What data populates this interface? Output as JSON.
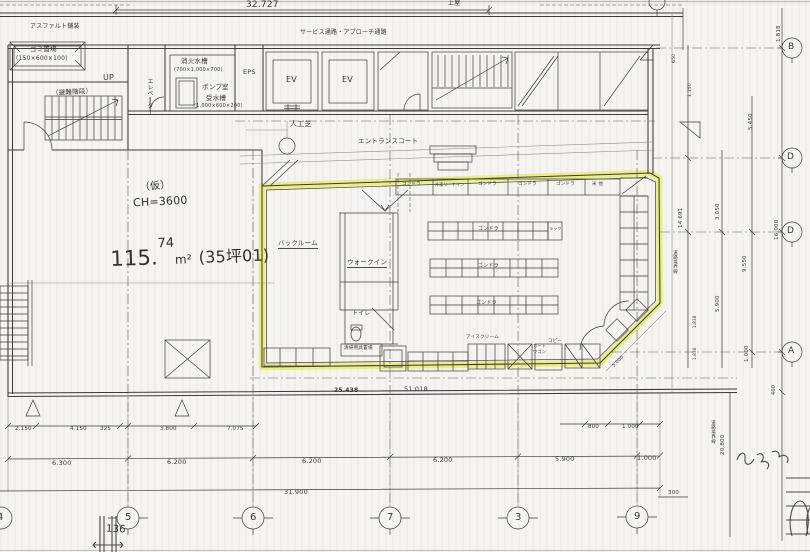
{
  "colors": {
    "highlight": "#e3ea52",
    "ink": "#3c3c3c",
    "paper": "#f5f4f0"
  },
  "top": {
    "dim_total": "32.727",
    "canopy": "上屋",
    "service_note": "サービス通路・アプローチ通路",
    "asphalt_note": "アスファルト舗装",
    "bin_room": "ゴミ置場",
    "bin_size": "(150×600×100)"
  },
  "rooms": {
    "up": "UP",
    "stair_note": "（避難階段）",
    "elevator": "エレベーター",
    "fire_tank": "消火水槽",
    "fire_tank_size": "(700×1,000×700)",
    "pump_room": "ポンプ室",
    "water_tank": "受水槽",
    "water_tank_size": "(1,000×600×200)",
    "eps": "EPS",
    "ev1": "EV",
    "ev2": "EV",
    "turf": "人工芝",
    "entrance_court": "エントランスコート"
  },
  "store": {
    "tenant_note": "（仮）",
    "ceiling_note": "CH=3600",
    "area_int": "115.",
    "area_dec": "74",
    "area_unit": "m²",
    "area_tsubo": "(35坪01)",
    "backroom": "バックルーム",
    "walkin": "ウォークイン",
    "toilet": "トイレ",
    "cleaning": "清掃用具置場",
    "ice": "アイスクリーム",
    "cart1": "カート",
    "cart2": "ワゴン",
    "copy": "コピー",
    "diag_dim": "5.000",
    "wall_fixtures": [
      "ゴンドラ",
      "冷凍リーチイン",
      "ゴンドラ",
      "ゴンドラ",
      "ゴンドラ",
      "米 他"
    ],
    "gondola1": "ゴンドラ",
    "gondola2": "ゴンドラ",
    "gondola3": "ゴンドラ",
    "rack": "ラック"
  },
  "levels": {
    "bm1": "25.438",
    "bm2": "51.018"
  },
  "dims": {
    "bottom_row1": [
      "2.150",
      "4.150",
      "325",
      "3.800",
      "7.075"
    ],
    "bottom_row1r": [
      "800",
      "1.000"
    ],
    "bottom_row2": [
      "6.300",
      "6.200",
      "6.200",
      "6.200",
      "5.900",
      "1.000"
    ],
    "bottom_total": "31.900",
    "d300": "300",
    "d400": "400",
    "right": {
      "d1818": "1.818",
      "d650": "650",
      "d1150": "1.150",
      "d5450": "5.450",
      "d14691": "14.691",
      "d3050": "3.050",
      "d16000": "16.000",
      "d9550": "9.550",
      "d5900": "5.900",
      "d1838": "1.838",
      "d1836": "1.836",
      "d1000": "1.000",
      "d20800": "20.800"
    },
    "road1": "道路境界線",
    "road2": "道路境界線"
  },
  "grid": {
    "bottom": [
      "4",
      "5",
      "6",
      "7",
      "3",
      "9"
    ],
    "right": [
      "B",
      "D",
      "D",
      "A"
    ]
  },
  "notes": {
    "hand136": "136"
  }
}
